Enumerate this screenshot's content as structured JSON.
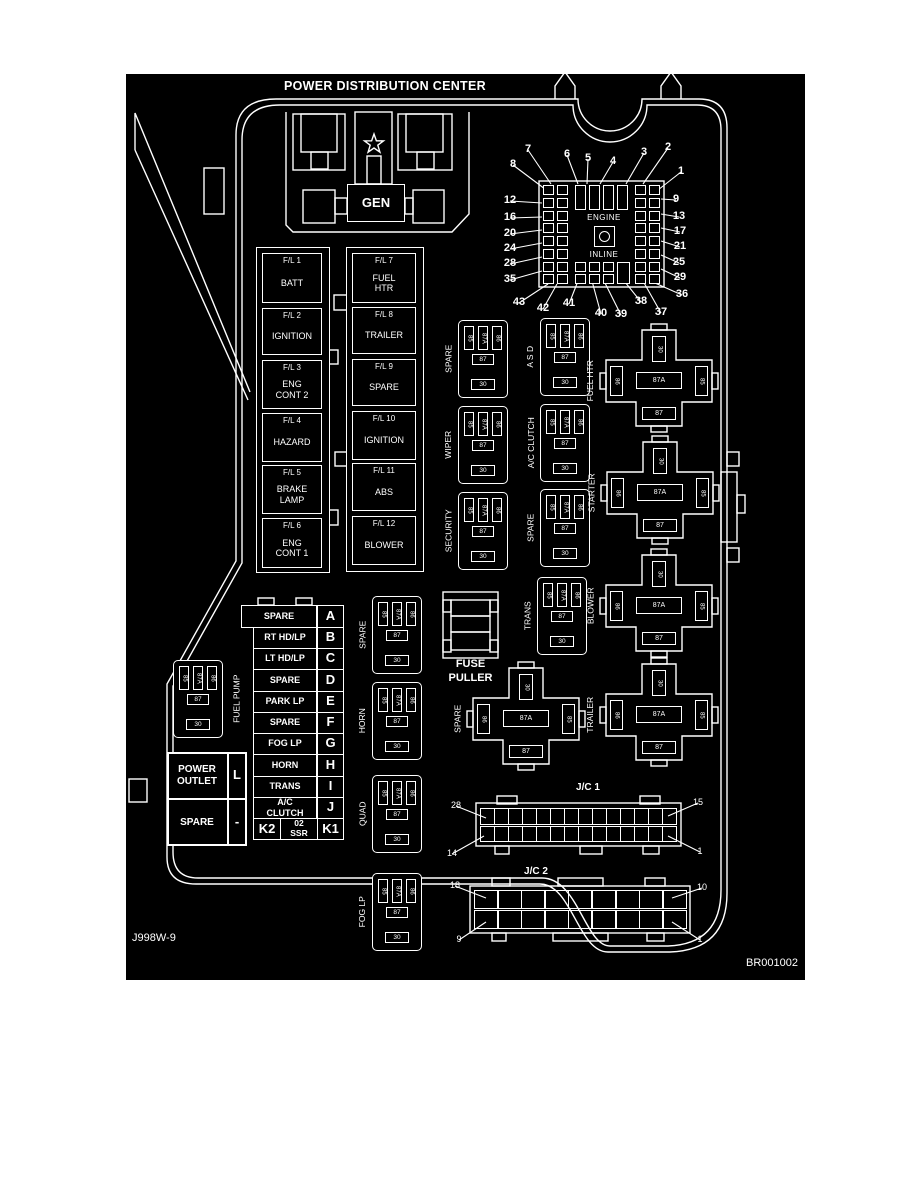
{
  "title": "POWER DISTRIBUTION CENTER",
  "codes": {
    "left": "J998W-9",
    "right": "BR001002"
  },
  "gen": {
    "label": "GEN",
    "logo": "pentastar-icon"
  },
  "fuse_grid": {
    "engine": "ENGINE",
    "inline": "INLINE",
    "callouts": [
      {
        "n": "7",
        "x": 528,
        "y": 150,
        "tx": 551,
        "ty": 184
      },
      {
        "n": "6",
        "x": 567,
        "y": 155,
        "tx": 578,
        "ty": 184
      },
      {
        "n": "5",
        "x": 588,
        "y": 159,
        "tx": 587,
        "ty": 184
      },
      {
        "n": "4",
        "x": 613,
        "y": 162,
        "tx": 600,
        "ty": 184
      },
      {
        "n": "3",
        "x": 644,
        "y": 153,
        "tx": 626,
        "ty": 184
      },
      {
        "n": "2",
        "x": 668,
        "y": 148,
        "tx": 643,
        "ty": 184
      },
      {
        "n": "1",
        "x": 681,
        "y": 172,
        "tx": 658,
        "ty": 190
      },
      {
        "n": "8",
        "x": 513,
        "y": 165,
        "tx": 545,
        "ty": 189
      },
      {
        "n": "12",
        "x": 510,
        "y": 201,
        "tx": 542,
        "ty": 203
      },
      {
        "n": "16",
        "x": 510,
        "y": 218,
        "tx": 542,
        "ty": 217
      },
      {
        "n": "20",
        "x": 510,
        "y": 234,
        "tx": 542,
        "ty": 230
      },
      {
        "n": "24",
        "x": 510,
        "y": 249,
        "tx": 542,
        "ty": 243
      },
      {
        "n": "28",
        "x": 510,
        "y": 264,
        "tx": 542,
        "ty": 257
      },
      {
        "n": "35",
        "x": 510,
        "y": 280,
        "tx": 542,
        "ty": 271
      },
      {
        "n": "9",
        "x": 676,
        "y": 200,
        "tx": 661,
        "ty": 199
      },
      {
        "n": "13",
        "x": 679,
        "y": 217,
        "tx": 661,
        "ty": 214
      },
      {
        "n": "17",
        "x": 680,
        "y": 232,
        "tx": 661,
        "ty": 228
      },
      {
        "n": "21",
        "x": 680,
        "y": 247,
        "tx": 661,
        "ty": 241
      },
      {
        "n": "25",
        "x": 679,
        "y": 263,
        "tx": 661,
        "ty": 255
      },
      {
        "n": "29",
        "x": 680,
        "y": 278,
        "tx": 661,
        "ty": 269
      },
      {
        "n": "36",
        "x": 682,
        "y": 295,
        "tx": 655,
        "ty": 283
      },
      {
        "n": "43",
        "x": 519,
        "y": 303,
        "tx": 548,
        "ty": 284
      },
      {
        "n": "42",
        "x": 543,
        "y": 309,
        "tx": 557,
        "ty": 284
      },
      {
        "n": "41",
        "x": 569,
        "y": 304,
        "tx": 578,
        "ty": 281
      },
      {
        "n": "40",
        "x": 601,
        "y": 314,
        "tx": 592,
        "ty": 281
      },
      {
        "n": "39",
        "x": 621,
        "y": 315,
        "tx": 604,
        "ty": 281
      },
      {
        "n": "38",
        "x": 641,
        "y": 302,
        "tx": 621,
        "ty": 277
      },
      {
        "n": "37",
        "x": 661,
        "y": 313,
        "tx": 643,
        "ty": 281
      }
    ]
  },
  "fl_left": [
    {
      "id": "F/L  1",
      "name": "BATT"
    },
    {
      "id": "F/L  2",
      "name": "IGNITION"
    },
    {
      "id": "F/L  3",
      "name": "ENG\nCONT 2"
    },
    {
      "id": "F/L 4",
      "name": "HAZARD"
    },
    {
      "id": "F/L 5",
      "name": "BRAKE\nLAMP"
    },
    {
      "id": "F/L 6",
      "name": "ENG\nCONT 1"
    }
  ],
  "fl_right": [
    {
      "id": "F/L 7",
      "name": "FUEL\nHTR"
    },
    {
      "id": "F/L 8",
      "name": "TRAILER"
    },
    {
      "id": "F/L 9",
      "name": "SPARE"
    },
    {
      "id": "F/L 10",
      "name": "IGNITION"
    },
    {
      "id": "F/L 11",
      "name": "ABS"
    },
    {
      "id": "F/L 12",
      "name": "BLOWER"
    }
  ],
  "relay_pins": {
    "v": [
      "85",
      "87A",
      "86"
    ],
    "mid": "87",
    "bot": "30"
  },
  "mini_relays": [
    {
      "label": "SPARE",
      "x": 458,
      "y": 320
    },
    {
      "label": "A S D",
      "x": 540,
      "y": 318
    },
    {
      "label": "WIPER",
      "x": 458,
      "y": 406
    },
    {
      "label": "A/C CLUTCH",
      "x": 540,
      "y": 404
    },
    {
      "label": "SECURITY",
      "x": 458,
      "y": 492
    },
    {
      "label": "SPARE",
      "x": 540,
      "y": 489
    },
    {
      "label": "TRANS",
      "x": 537,
      "y": 577
    },
    {
      "label": "SPARE",
      "x": 372,
      "y": 596
    },
    {
      "label": "HORN",
      "x": 372,
      "y": 682
    },
    {
      "label": "QUAD",
      "x": 372,
      "y": 775
    },
    {
      "label": "FOG LP",
      "x": 372,
      "y": 873
    },
    {
      "label": "FUEL PUMP",
      "x": 173,
      "y": 660,
      "label_right": true
    }
  ],
  "cross_pins": {
    "top": "30",
    "left": "86",
    "center": "87A",
    "right": "85",
    "bottom": "87"
  },
  "cross_relays": [
    {
      "label": "FUEL HTR",
      "cx": 659,
      "cy": 381
    },
    {
      "label": "STARTER",
      "cx": 660,
      "cy": 493
    },
    {
      "label": "BLOWER",
      "cx": 659,
      "cy": 606
    },
    {
      "label": "TRAILER",
      "cx": 659,
      "cy": 715
    },
    {
      "label": "SPARE",
      "cx": 526,
      "cy": 719
    }
  ],
  "cavity_table": {
    "rows": [
      {
        "name": "SPARE",
        "letter": "A"
      },
      {
        "name": "RT HD/LP",
        "letter": "B"
      },
      {
        "name": "LT HD/LP",
        "letter": "C"
      },
      {
        "name": "SPARE",
        "letter": "D"
      },
      {
        "name": "PARK LP",
        "letter": "E"
      },
      {
        "name": "SPARE",
        "letter": "F"
      },
      {
        "name": "FOG LP",
        "letter": "G"
      },
      {
        "name": "HORN",
        "letter": "H"
      },
      {
        "name": "TRANS",
        "letter": "I"
      },
      {
        "name": "A/C\nCLUTCH",
        "letter": "J"
      }
    ],
    "k_row": {
      "left": "K2",
      "center": "02\nSSR",
      "right": "K1"
    }
  },
  "power_outlet": {
    "rows": [
      {
        "name": "POWER\nOUTLET",
        "letter": "L"
      },
      {
        "name": "SPARE",
        "letter": "-"
      }
    ]
  },
  "fuse_puller": {
    "line1": "FUSE",
    "line2": "PULLER"
  },
  "jc1": {
    "label": "J/C 1",
    "callouts": [
      {
        "n": "28",
        "x": 456,
        "y": 806,
        "tx": 486,
        "ty": 818
      },
      {
        "n": "15",
        "x": 698,
        "y": 803,
        "tx": 668,
        "ty": 816
      },
      {
        "n": "14",
        "x": 452,
        "y": 854,
        "tx": 484,
        "ty": 836
      },
      {
        "n": "1",
        "x": 700,
        "y": 852,
        "tx": 668,
        "ty": 836
      }
    ]
  },
  "jc2": {
    "label": "J/C 2",
    "callouts": [
      {
        "n": "18",
        "x": 455,
        "y": 886,
        "tx": 486,
        "ty": 898
      },
      {
        "n": "10",
        "x": 702,
        "y": 888,
        "tx": 672,
        "ty": 898
      },
      {
        "n": "9",
        "x": 459,
        "y": 940,
        "tx": 486,
        "ty": 922
      },
      {
        "n": "1",
        "x": 700,
        "y": 940,
        "tx": 672,
        "ty": 922
      }
    ]
  }
}
